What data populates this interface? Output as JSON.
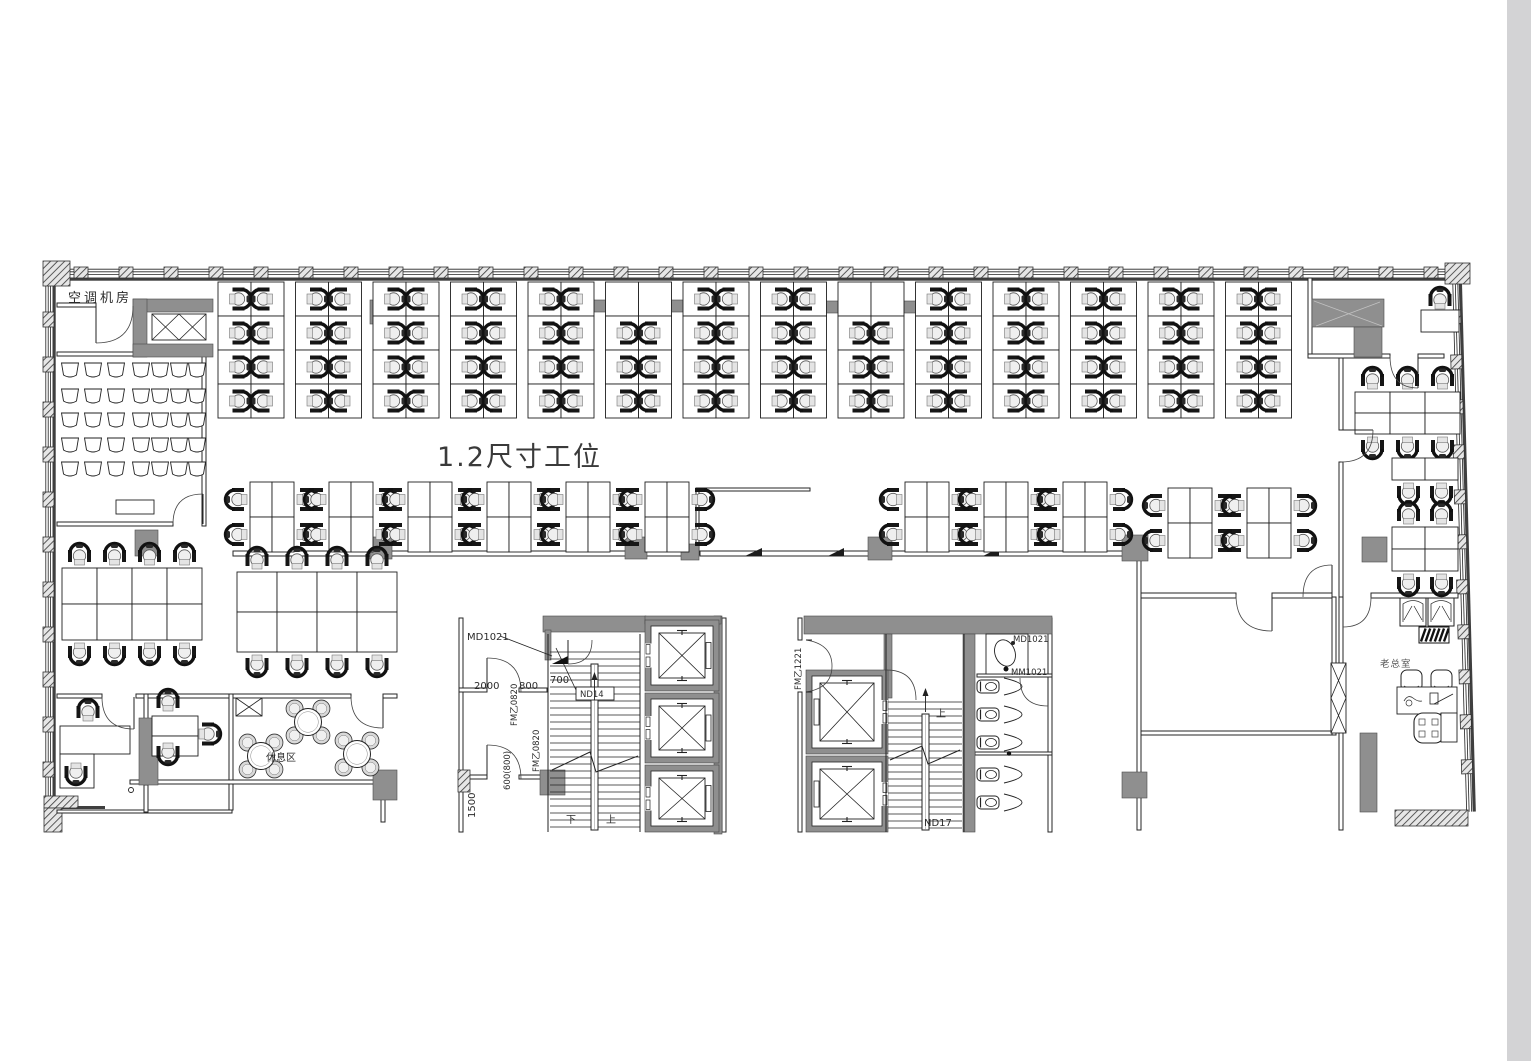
{
  "floor_plan": {
    "areas": {
      "ac_room": "空调机房",
      "workstation_area": "1.2尺寸工位",
      "rest_area": "休息区",
      "boss_office": "老总室"
    },
    "core1": {
      "door_tag": "MD1021",
      "dim_width": "2000",
      "dim_a": "800",
      "dim_b": "700",
      "fire_door_upper": "FM乙0820",
      "fire_door_lower": "FM乙0820",
      "dim_c": "600(800)",
      "dim_d": "1500",
      "stair_tag": "ND14",
      "down_label": "下",
      "up_label": "上"
    },
    "core2": {
      "fire_door": "FM乙1221",
      "up_label": "上",
      "stair_tag": "ND17",
      "door_tag": "MD1021",
      "access_panel_tag": "MM1021"
    }
  }
}
